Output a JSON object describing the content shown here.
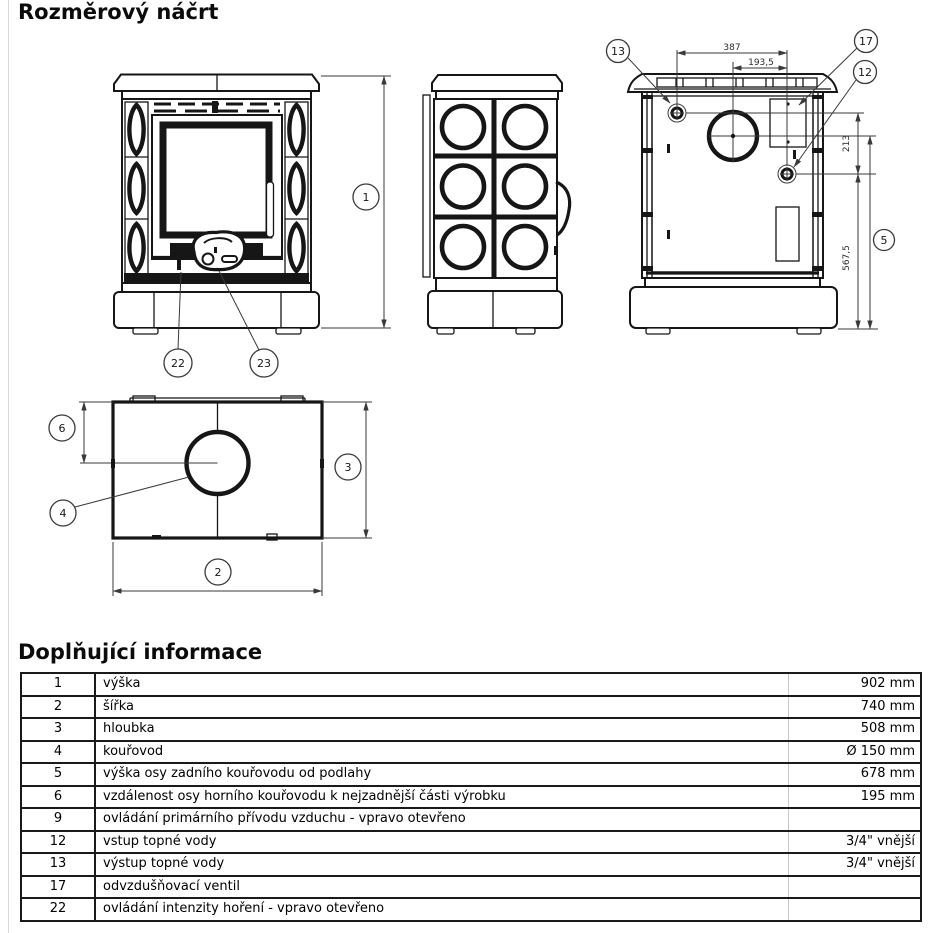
{
  "page": {
    "title": "Rozměrový náčrt",
    "section_title": "Doplňující informace"
  },
  "drawing": {
    "balloons": {
      "b1": "1",
      "b2": "2",
      "b3": "3",
      "b4": "4",
      "b5": "5",
      "b6": "6",
      "b12": "12",
      "b13": "13",
      "b17": "17",
      "b22": "22",
      "b23": "23"
    },
    "dims": {
      "d387": "387",
      "d193": "193,5",
      "d213": "213",
      "d567": "567,5"
    }
  },
  "info_table": {
    "rows": [
      {
        "num": "1",
        "label": "výška",
        "value": "902 mm"
      },
      {
        "num": "2",
        "label": "šířka",
        "value": "740 mm"
      },
      {
        "num": "3",
        "label": "hloubka",
        "value": "508 mm"
      },
      {
        "num": "4",
        "label": "kouřovod",
        "value": "Ø 150 mm"
      },
      {
        "num": "5",
        "label": "výška osy zadního kouřovodu od podlahy",
        "value": "678 mm"
      },
      {
        "num": "6",
        "label": "vzdálenost osy horního kouřovodu k nejzadnější části výrobku",
        "value": "195 mm"
      },
      {
        "num": "9",
        "label": "ovládání primárního přívodu vzduchu - vpravo otevřeno",
        "value": ""
      },
      {
        "num": "12",
        "label": "vstup topné vody",
        "value": "3/4\" vnější"
      },
      {
        "num": "13",
        "label": "výstup topné vody",
        "value": "3/4\" vnější"
      },
      {
        "num": "17",
        "label": "odvzdušňovací ventil",
        "value": ""
      },
      {
        "num": "22",
        "label": "ovládání intenzity hoření - vpravo otevřeno",
        "value": ""
      }
    ]
  }
}
